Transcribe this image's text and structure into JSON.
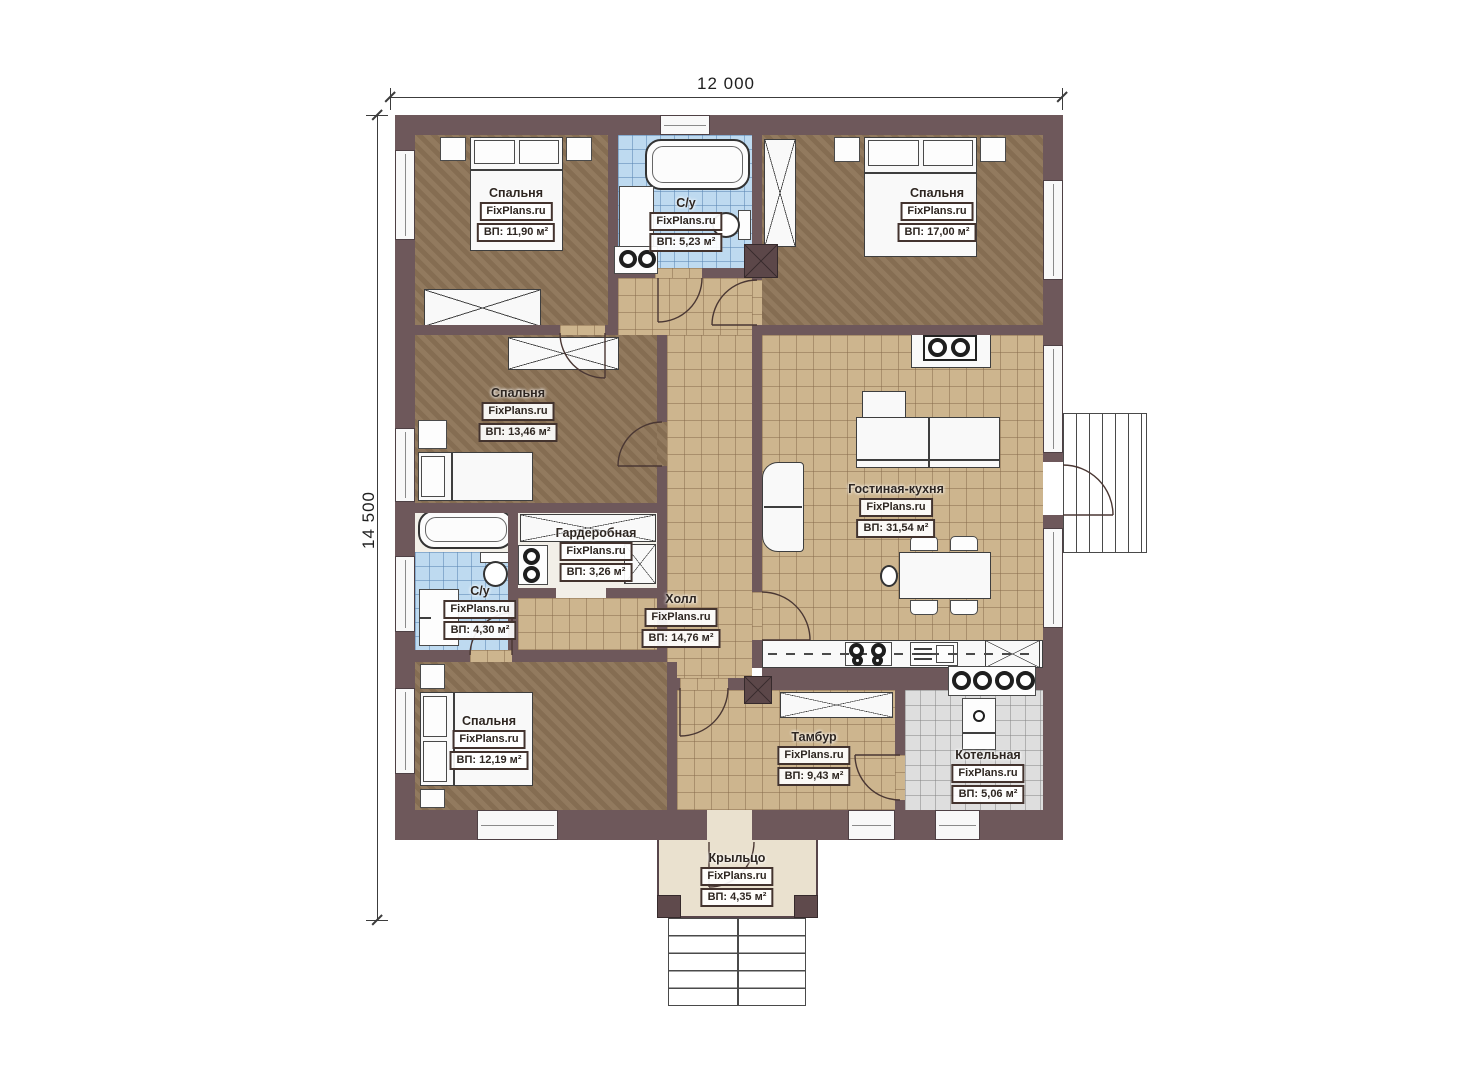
{
  "plan": {
    "type": "floor-plan",
    "source_watermark": "FixPlans.ru"
  },
  "dimensions": {
    "width": "12 000",
    "height": "14 500"
  },
  "rooms": [
    {
      "id": "bedroom-top-left",
      "name": "Спальня",
      "watermark": "FixPlans.ru",
      "area": "ВП: 11,90 м²"
    },
    {
      "id": "bathroom-top",
      "name": "С/у",
      "watermark": "FixPlans.ru",
      "area": "ВП: 5,23 м²"
    },
    {
      "id": "bedroom-top-right",
      "name": "Спальня",
      "watermark": "FixPlans.ru",
      "area": "ВП: 17,00 м²"
    },
    {
      "id": "bedroom-mid-left",
      "name": "Спальня",
      "watermark": "FixPlans.ru",
      "area": "ВП: 13,46 м²"
    },
    {
      "id": "living-kitchen",
      "name": "Гостиная-кухня",
      "watermark": "FixPlans.ru",
      "area": "ВП: 31,54 м²"
    },
    {
      "id": "wardrobe-room",
      "name": "Гардеробная",
      "watermark": "FixPlans.ru",
      "area": "ВП: 3,26 м²"
    },
    {
      "id": "bathroom-bottom",
      "name": "С/у",
      "watermark": "FixPlans.ru",
      "area": "ВП: 4,30 м²"
    },
    {
      "id": "hall",
      "name": "Холл",
      "watermark": "FixPlans.ru",
      "area": "ВП: 14,76 м²"
    },
    {
      "id": "bedroom-bottom-left",
      "name": "Спальня",
      "watermark": "FixPlans.ru",
      "area": "ВП: 12,19 м²"
    },
    {
      "id": "vestibule",
      "name": "Тамбур",
      "watermark": "FixPlans.ru",
      "area": "ВП: 9,43 м²"
    },
    {
      "id": "boiler-room",
      "name": "Котельная",
      "watermark": "FixPlans.ru",
      "area": "ВП: 5,06 м²"
    },
    {
      "id": "porch",
      "name": "Крыльцо",
      "watermark": "FixPlans.ru",
      "area": "ВП: 4,35 м²"
    }
  ],
  "palette": {
    "wall": "#6e585b",
    "bedroom_floor": "#8c7356",
    "tile_tan": "#cdb58e",
    "tile_blue": "#bedaf0",
    "tile_gray": "#dedede",
    "porch": "#eae1cf",
    "line": "#4a3733"
  }
}
